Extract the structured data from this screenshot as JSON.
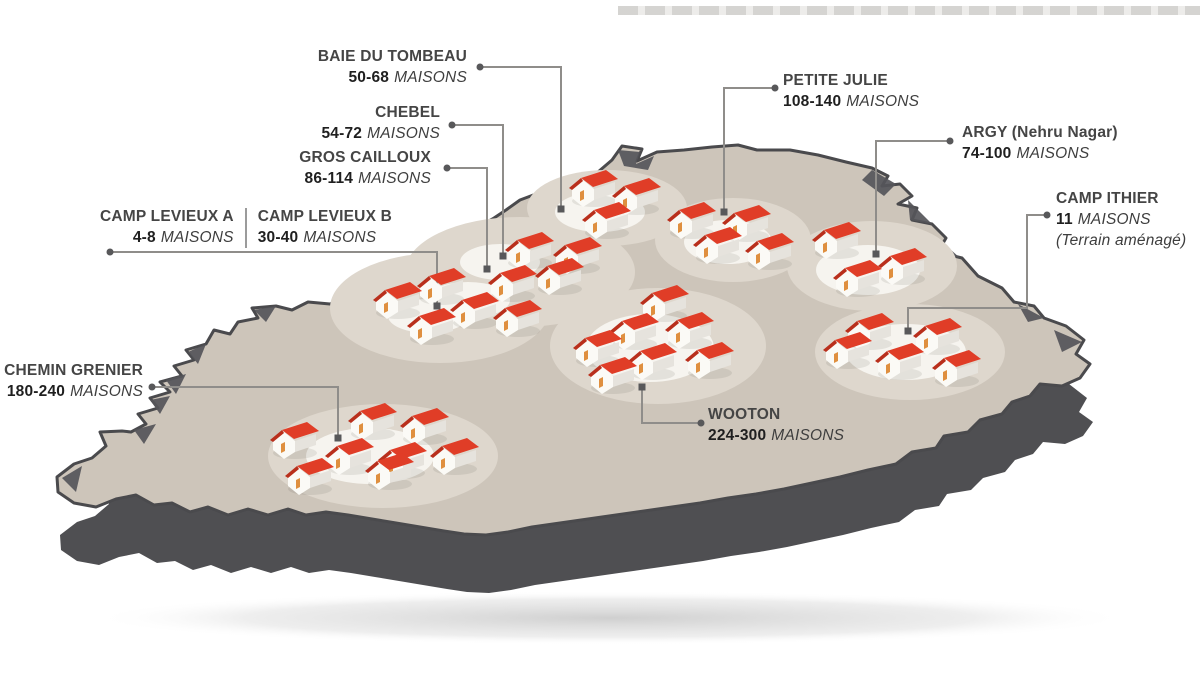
{
  "figure": {
    "type": "map-infographic",
    "region": "Mauritius"
  },
  "colors": {
    "background": "#ffffff",
    "island_top": "#cdc5ba",
    "island_side": "#4f4f52",
    "clearing": "#ded7cd",
    "clearing_inner": "#f6f4ef",
    "roof_red": "#e03d27",
    "roof_red_dark": "#b92f1c",
    "door_orange": "#df8f3f",
    "leader_line": "#8f8d8a",
    "leader_marker": "#58585a",
    "text": "#3e3e3e",
    "number_text": "#1f1f1f"
  },
  "settlements": [
    {
      "id": "baie-du-tombeau",
      "name": "BAIE DU TOMBEAU",
      "range": "50-68",
      "unit": "MAISONS",
      "note": ""
    },
    {
      "id": "chebel",
      "name": "CHEBEL",
      "range": "54-72",
      "unit": "MAISONS",
      "note": ""
    },
    {
      "id": "gros-cailloux",
      "name": "GROS CAILLOUX",
      "range": "86-114",
      "unit": "MAISONS",
      "note": ""
    },
    {
      "id": "camp-levieux-a",
      "name": "CAMP LEVIEUX A",
      "range": "4-8",
      "unit": "MAISONS",
      "note": ""
    },
    {
      "id": "camp-levieux-b",
      "name": "CAMP LEVIEUX B",
      "range": "30-40",
      "unit": "MAISONS",
      "note": ""
    },
    {
      "id": "petite-julie",
      "name": "PETITE JULIE",
      "range": "108-140",
      "unit": "MAISONS",
      "note": ""
    },
    {
      "id": "argy",
      "name": "ARGY (Nehru Nagar)",
      "range": "74-100",
      "unit": "MAISONS",
      "note": ""
    },
    {
      "id": "camp-ithier",
      "name": "CAMP ITHIER",
      "range": "11",
      "unit": "MAISONS",
      "note": "(Terrain aménagé)"
    },
    {
      "id": "chemin-grenier",
      "name": "CHEMIN GRENIER",
      "range": "180-240",
      "unit": "MAISONS",
      "note": ""
    },
    {
      "id": "wooton",
      "name": "WOOTON",
      "range": "224-300",
      "unit": "MAISONS",
      "note": ""
    }
  ],
  "map": {
    "leaders": [
      {
        "for": "baie-du-tombeau",
        "points": [
          [
            480,
            67
          ],
          [
            561,
            67
          ],
          [
            561,
            209
          ]
        ]
      },
      {
        "for": "chebel",
        "points": [
          [
            452,
            125
          ],
          [
            503,
            125
          ],
          [
            503,
            256
          ]
        ]
      },
      {
        "for": "gros-cailloux",
        "points": [
          [
            447,
            168
          ],
          [
            487,
            168
          ],
          [
            487,
            269
          ]
        ]
      },
      {
        "for": "camp-levieux",
        "points": [
          [
            110,
            252
          ],
          [
            437,
            252
          ],
          [
            437,
            306
          ]
        ]
      },
      {
        "for": "petite-julie",
        "points": [
          [
            775,
            88
          ],
          [
            724,
            88
          ],
          [
            724,
            212
          ]
        ]
      },
      {
        "for": "argy",
        "points": [
          [
            950,
            141
          ],
          [
            876,
            141
          ],
          [
            876,
            254
          ]
        ]
      },
      {
        "for": "camp-ithier",
        "points": [
          [
            1047,
            215
          ],
          [
            1027,
            215
          ],
          [
            1027,
            308
          ],
          [
            908,
            308
          ],
          [
            908,
            331
          ]
        ]
      },
      {
        "for": "chemin-grenier",
        "points": [
          [
            152,
            387
          ],
          [
            338,
            387
          ],
          [
            338,
            438
          ]
        ]
      },
      {
        "for": "wooton",
        "points": [
          [
            701,
            423
          ],
          [
            642,
            423
          ],
          [
            642,
            387
          ]
        ]
      }
    ],
    "clusters": [
      {
        "id": "baie-du-tombeau",
        "outer": [
          [
            607,
            208,
            80,
            38
          ]
        ],
        "inner": [
          [
            600,
            212,
            45,
            20
          ]
        ],
        "houses": [
          [
            594,
            190
          ],
          [
            637,
            198
          ],
          [
            607,
            222
          ]
        ]
      },
      {
        "id": "chebel-gros-cailloux-camp-levieux",
        "outer": [
          [
            520,
            272,
            115,
            55
          ],
          [
            440,
            308,
            110,
            55
          ]
        ],
        "inner": [
          [
            500,
            262,
            40,
            18
          ],
          [
            468,
            300,
            42,
            18
          ],
          [
            428,
            316,
            40,
            17
          ]
        ],
        "houses": [
          [
            530,
            252
          ],
          [
            578,
            257
          ],
          [
            560,
            278
          ],
          [
            513,
            285
          ],
          [
            442,
            288
          ],
          [
            398,
            302
          ],
          [
            475,
            312
          ],
          [
            518,
            320
          ],
          [
            432,
            328
          ]
        ]
      },
      {
        "id": "petite-julie",
        "outer": [
          [
            733,
            240,
            78,
            42
          ]
        ],
        "inner": [
          [
            728,
            242,
            44,
            22
          ]
        ],
        "houses": [
          [
            692,
            222
          ],
          [
            747,
            225
          ],
          [
            718,
            247
          ],
          [
            770,
            253
          ]
        ]
      },
      {
        "id": "argy",
        "outer": [
          [
            872,
            266,
            85,
            45
          ]
        ],
        "inner": [
          [
            868,
            270,
            52,
            25
          ]
        ],
        "houses": [
          [
            837,
            242
          ],
          [
            903,
            268
          ],
          [
            858,
            280
          ]
        ]
      },
      {
        "id": "camp-ithier",
        "outer": [
          [
            910,
            352,
            95,
            48
          ]
        ],
        "inner": [
          [
            906,
            352,
            60,
            28
          ]
        ],
        "houses": [
          [
            870,
            333
          ],
          [
            938,
            338
          ],
          [
            848,
            352
          ],
          [
            900,
            363
          ],
          [
            957,
            370
          ]
        ]
      },
      {
        "id": "wooton",
        "outer": [
          [
            658,
            346,
            108,
            58
          ]
        ],
        "inner": [
          [
            650,
            348,
            64,
            34
          ]
        ],
        "houses": [
          [
            665,
            305
          ],
          [
            690,
            332
          ],
          [
            635,
            333
          ],
          [
            598,
            350
          ],
          [
            710,
            362
          ],
          [
            653,
            363
          ],
          [
            613,
            377
          ]
        ]
      },
      {
        "id": "chemin-grenier",
        "outer": [
          [
            383,
            456,
            115,
            52
          ]
        ],
        "inner": [
          [
            370,
            456,
            64,
            28
          ]
        ],
        "houses": [
          [
            373,
            423
          ],
          [
            425,
            428
          ],
          [
            295,
            442
          ],
          [
            455,
            458
          ],
          [
            350,
            458
          ],
          [
            403,
            462
          ],
          [
            390,
            473
          ],
          [
            310,
            478
          ]
        ]
      }
    ]
  }
}
